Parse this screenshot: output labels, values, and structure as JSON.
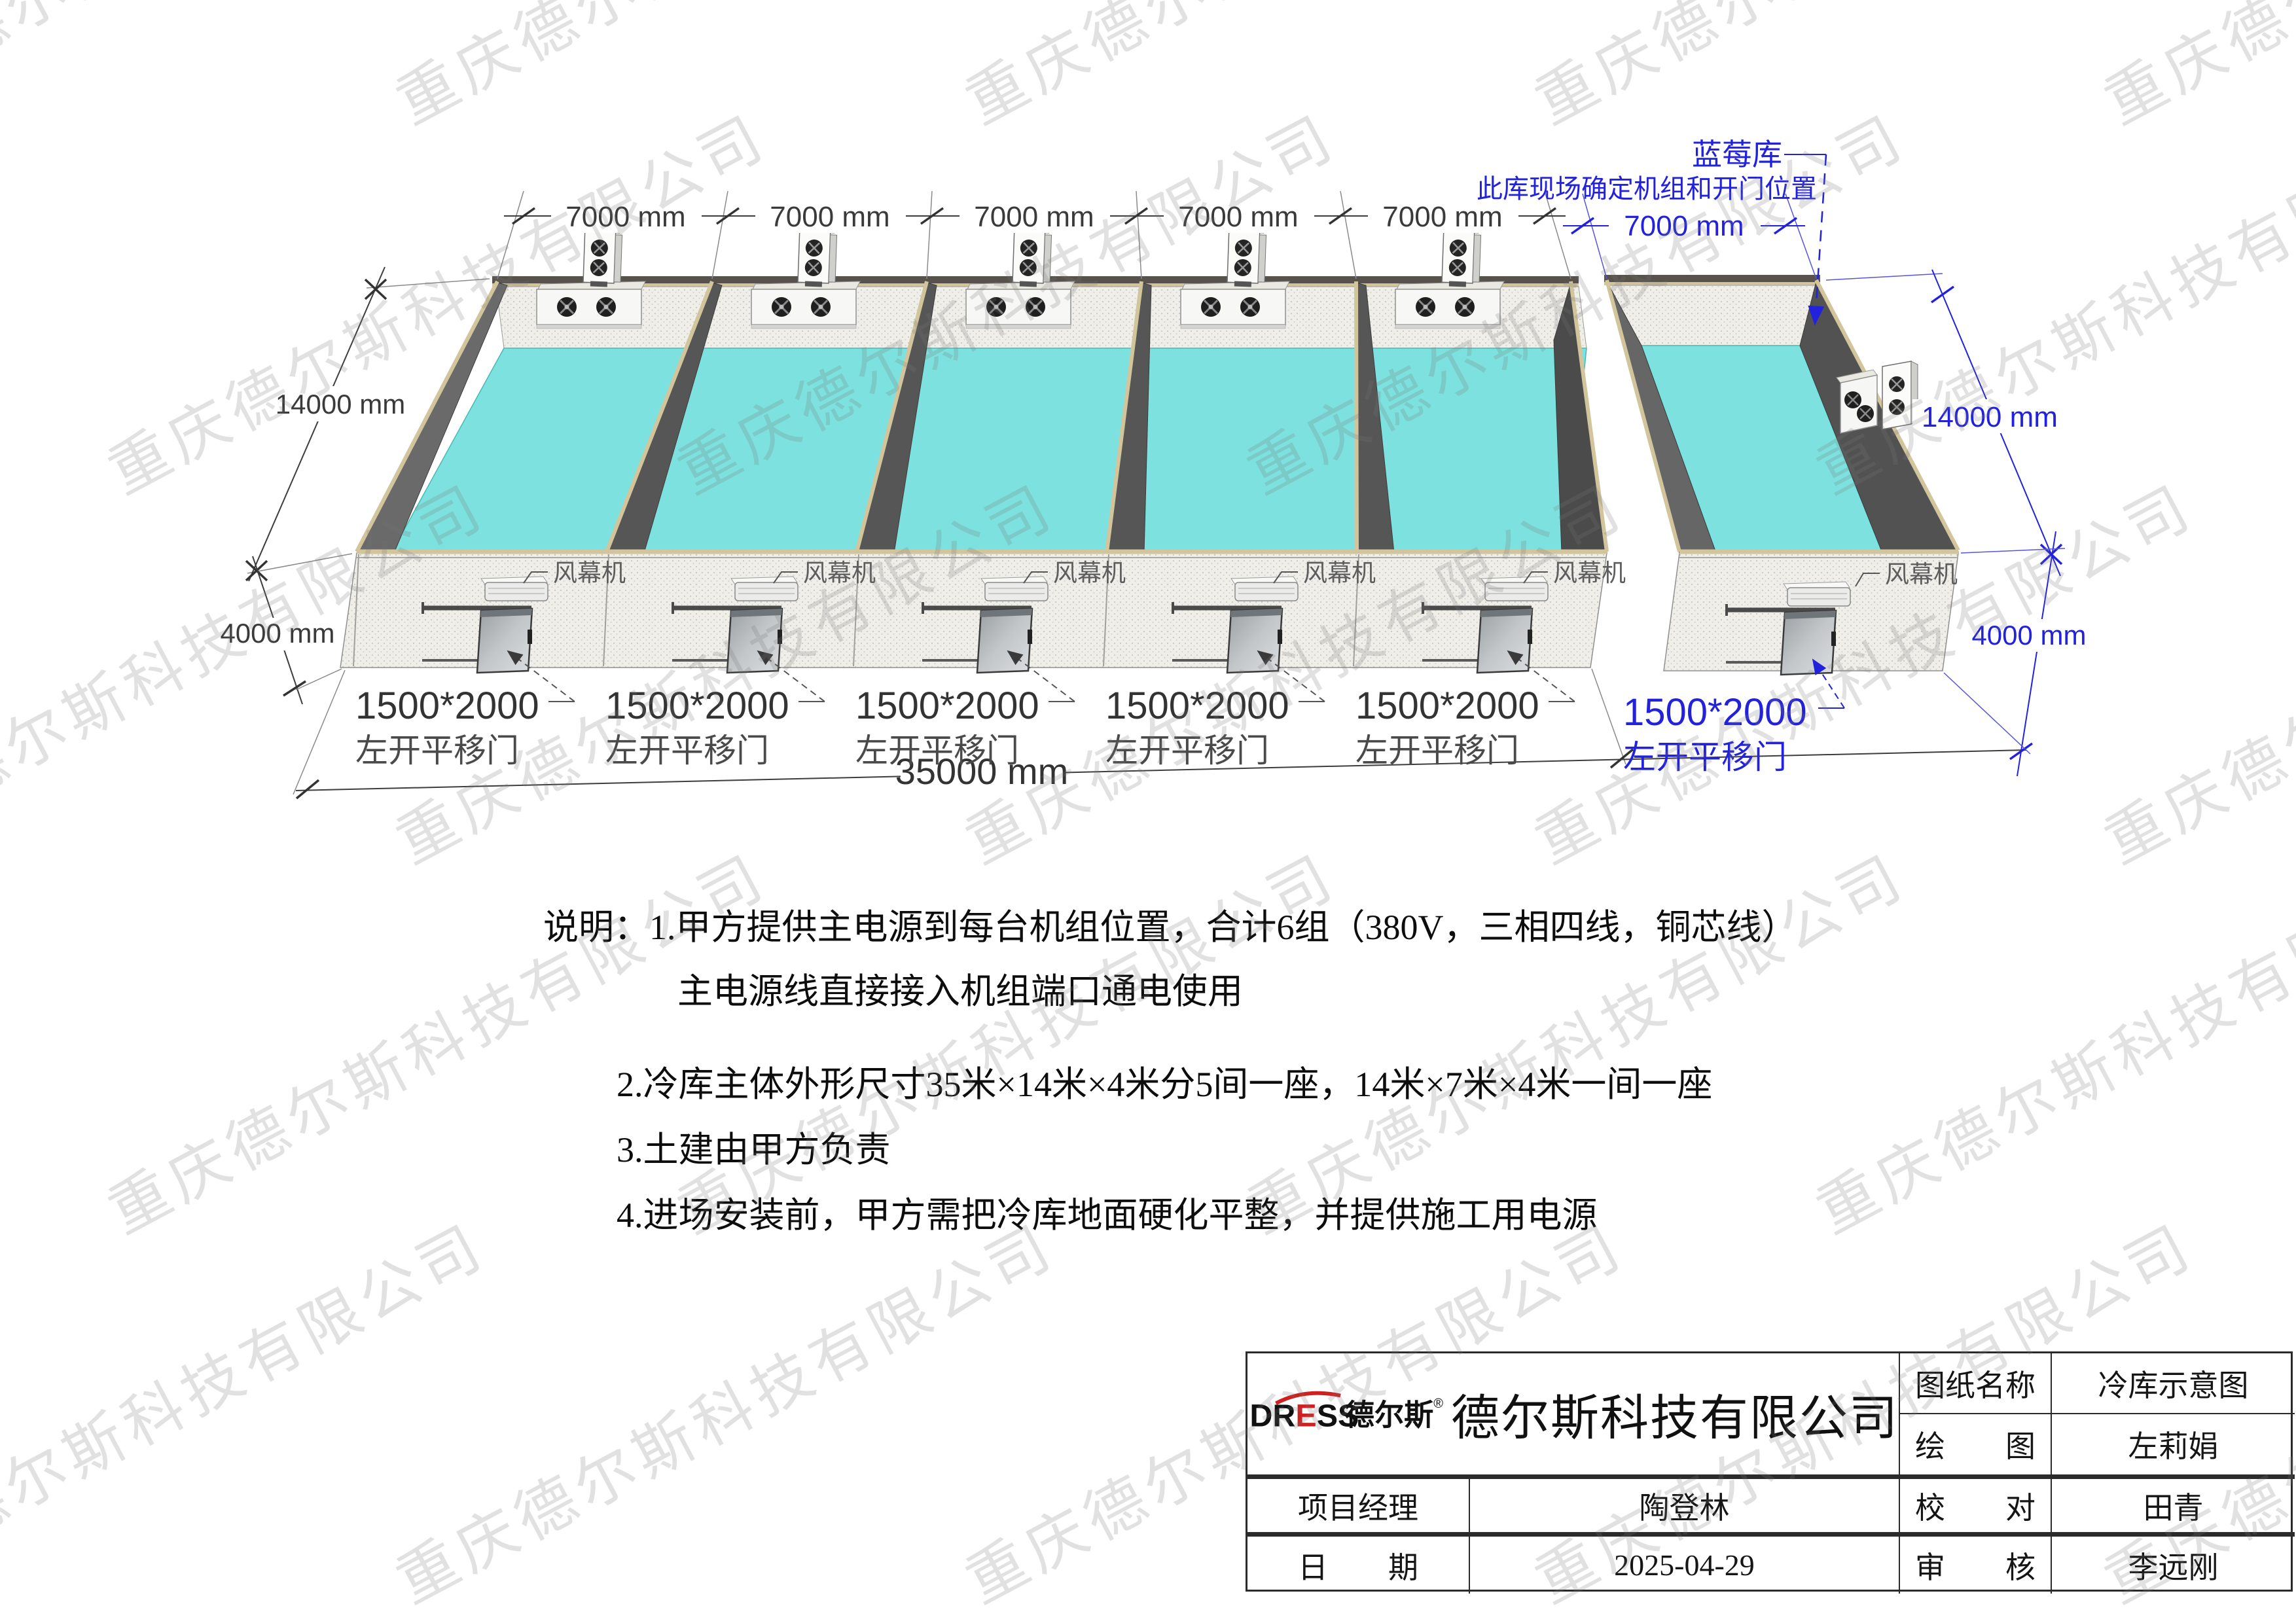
{
  "watermark": {
    "text": "重庆德尔斯科技有限公司"
  },
  "drawing": {
    "room_width_dims": [
      "7000 mm",
      "7000 mm",
      "7000 mm",
      "7000 mm",
      "7000 mm"
    ],
    "depth_dim": "14000 mm",
    "height_dim": "4000 mm",
    "total_width_dim": "35000 mm",
    "doors": [
      {
        "size": "1500*2000",
        "type": "左开平移门"
      },
      {
        "size": "1500*2000",
        "type": "左开平移门"
      },
      {
        "size": "1500*2000",
        "type": "左开平移门"
      },
      {
        "size": "1500*2000",
        "type": "左开平移门"
      },
      {
        "size": "1500*2000",
        "type": "左开平移门"
      }
    ],
    "air_curtains": [
      "风幕机",
      "风幕机",
      "风幕机",
      "风幕机",
      "风幕机"
    ],
    "blueberry": {
      "name": "蓝莓库",
      "note": "此库现场确定机组和开门位置",
      "width_dim": "7000 mm",
      "depth_dim": "14000 mm",
      "height_dim": "4000 mm",
      "door_size": "1500*2000",
      "door_type": "左开平移门",
      "air_curtain": "风幕机"
    },
    "colors": {
      "floor_cyan": "#7de2df",
      "wall_dark": "#565656",
      "edge_tan": "#d2c59c",
      "dim_blue": "#2222dd",
      "logo_red": "#cf1f1f"
    }
  },
  "notes": {
    "lines": [
      "说明：1.甲方提供主电源到每台机组位置，合计6组（380V，三相四线，铜芯线）",
      "主电源线直接接入机组端口通电使用",
      "2.冷库主体外形尺寸35米×14米×4米分5间一座，14米×7米×4米一间一座",
      "3.土建由甲方负责",
      "4.进场安装前，甲方需把冷库地面硬化平整，并提供施工用电源"
    ]
  },
  "title_block": {
    "logo": {
      "latin_pre": "DR",
      "latin_mid": "E",
      "latin_post": "SS",
      "cn": "德尔斯",
      "reg": "®"
    },
    "company": "德尔斯科技有限公司",
    "drawing_name_label": "图纸名称",
    "drawing_name": "冷库示意图",
    "draftsman_label": "绘　　图",
    "draftsman": "左莉娟",
    "project_manager_label": "项目经理",
    "project_manager": "陶登林",
    "checker_label": "校　　对",
    "checker": "田青",
    "date_label": "日　　期",
    "date": "2025-04-29",
    "auditor_label": "审　　核",
    "auditor": "李远刚"
  }
}
